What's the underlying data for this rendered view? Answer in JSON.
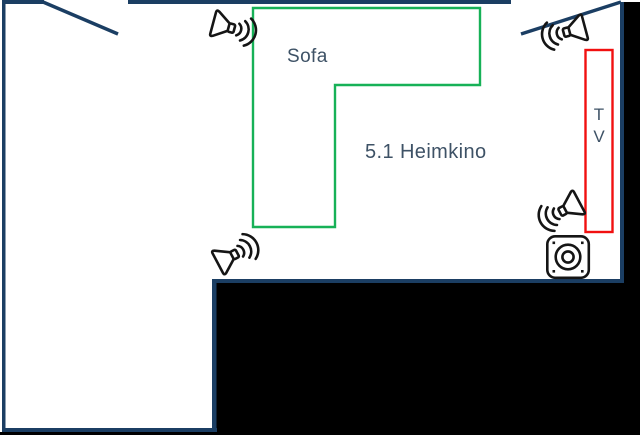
{
  "diagram": {
    "title": "5.1 Heimkino",
    "labels": {
      "sofa": "Sofa",
      "room_caption": "5.1 Heimkino",
      "tv_line1": "T",
      "tv_line2": "V"
    },
    "colors": {
      "wall": "#1b3e63",
      "outside": "#000000",
      "room_fill": "#ffffff",
      "sofa_outline": "#17b157",
      "tv_outline": "#f11010",
      "label_text": "#3e5266",
      "icon": "#151515"
    },
    "icons": {
      "speakers": [
        "speaker-top-left-icon",
        "speaker-top-right-icon",
        "speaker-bottom-left-icon",
        "speaker-bottom-right-icon"
      ],
      "subwoofer": "subwoofer-icon",
      "doors": [
        "door-swing-top-left",
        "door-swing-top-right"
      ]
    }
  }
}
